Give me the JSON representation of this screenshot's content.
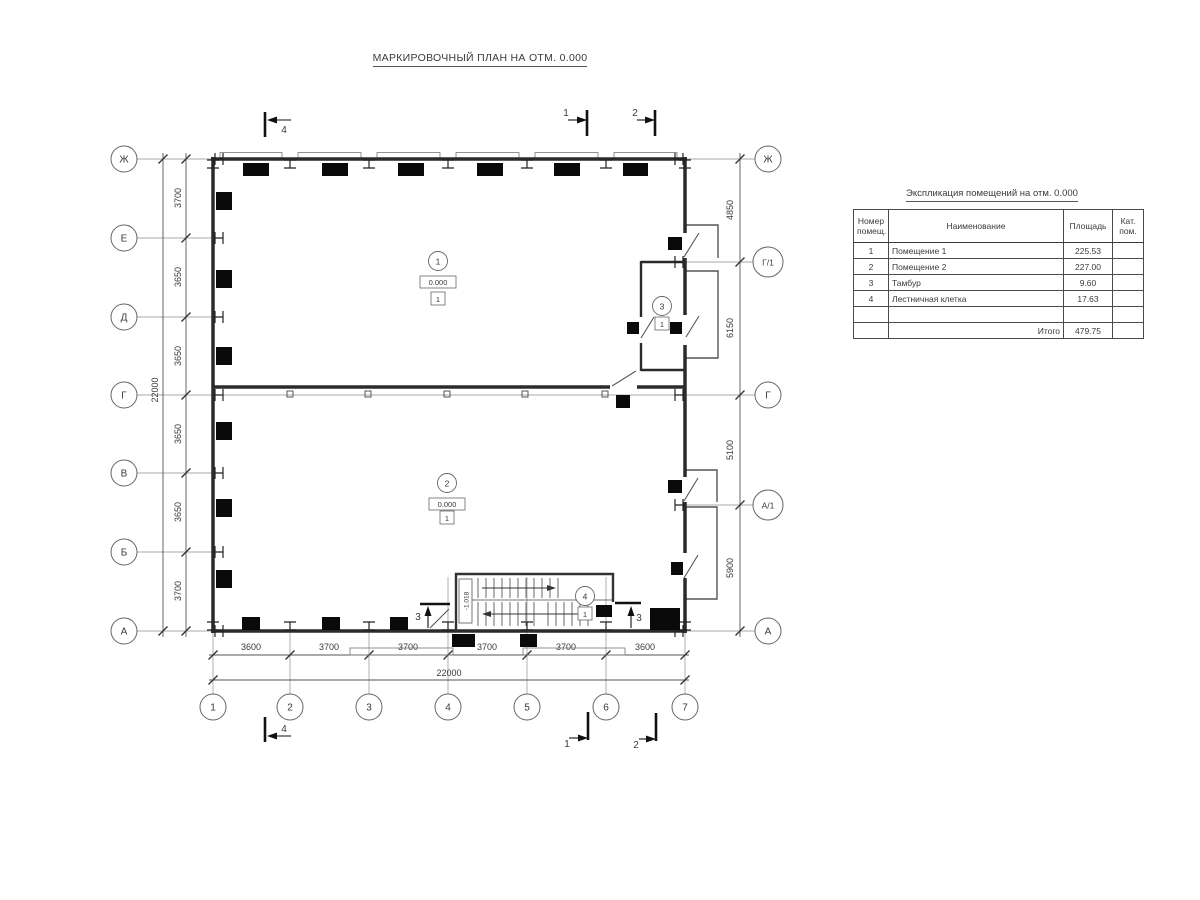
{
  "drawing": {
    "title": "МАРКИРОВОЧНЫЙ ПЛАН НА ОТМ. 0.000"
  },
  "colors": {
    "line": "#3a3a3a",
    "wall": "#2b2b2b",
    "mark": "#0a0a0a",
    "axis": "#9a9a9a"
  },
  "axes": {
    "left": [
      "Ж",
      "Е",
      "Д",
      "Г",
      "В",
      "Б",
      "А"
    ],
    "right": [
      "Ж",
      "Г/1",
      "Г",
      "А/1",
      "А"
    ],
    "bottom": [
      "1",
      "2",
      "3",
      "4",
      "5",
      "6",
      "7"
    ]
  },
  "dimensions": {
    "left_segments": [
      "3700",
      "3650",
      "3650",
      "3650",
      "3650",
      "3700"
    ],
    "left_total": "22000",
    "bottom_segments": [
      "3600",
      "3700",
      "3700",
      "3700",
      "3700",
      "3600"
    ],
    "bottom_total": "22000",
    "right_segments": [
      "4850",
      "6150",
      "5100",
      "5900"
    ]
  },
  "rooms": {
    "room1": {
      "number": "1",
      "elevation": "0.000",
      "floor_type": "1"
    },
    "room2": {
      "number": "2",
      "elevation": "0.000",
      "floor_type": "1"
    },
    "room3": {
      "number": "3",
      "floor_type": "1"
    },
    "room4": {
      "number": "4",
      "floor_type": "1"
    }
  },
  "stair": {
    "elevation": "-1.018"
  },
  "sections": {
    "s1": "1",
    "s2": "2",
    "s3": "3",
    "s4": "4"
  },
  "schedule": {
    "title": "Экспликация помещений на отм. 0.000",
    "headers": {
      "number": "Номер\nпомещ.",
      "name": "Наименование",
      "area": "Площадь",
      "category": "Кат.\nпом."
    },
    "rows": [
      {
        "num": "1",
        "name": "Помещение 1",
        "area": "225.53",
        "cat": ""
      },
      {
        "num": "2",
        "name": "Помещение 2",
        "area": "227.00",
        "cat": ""
      },
      {
        "num": "3",
        "name": "Тамбур",
        "area": "9.60",
        "cat": ""
      },
      {
        "num": "4",
        "name": "Лестничная клетка",
        "area": "17.63",
        "cat": ""
      },
      {
        "num": "",
        "name": "",
        "area": "",
        "cat": ""
      }
    ],
    "total_label": "Итого",
    "total_value": "479.75"
  }
}
